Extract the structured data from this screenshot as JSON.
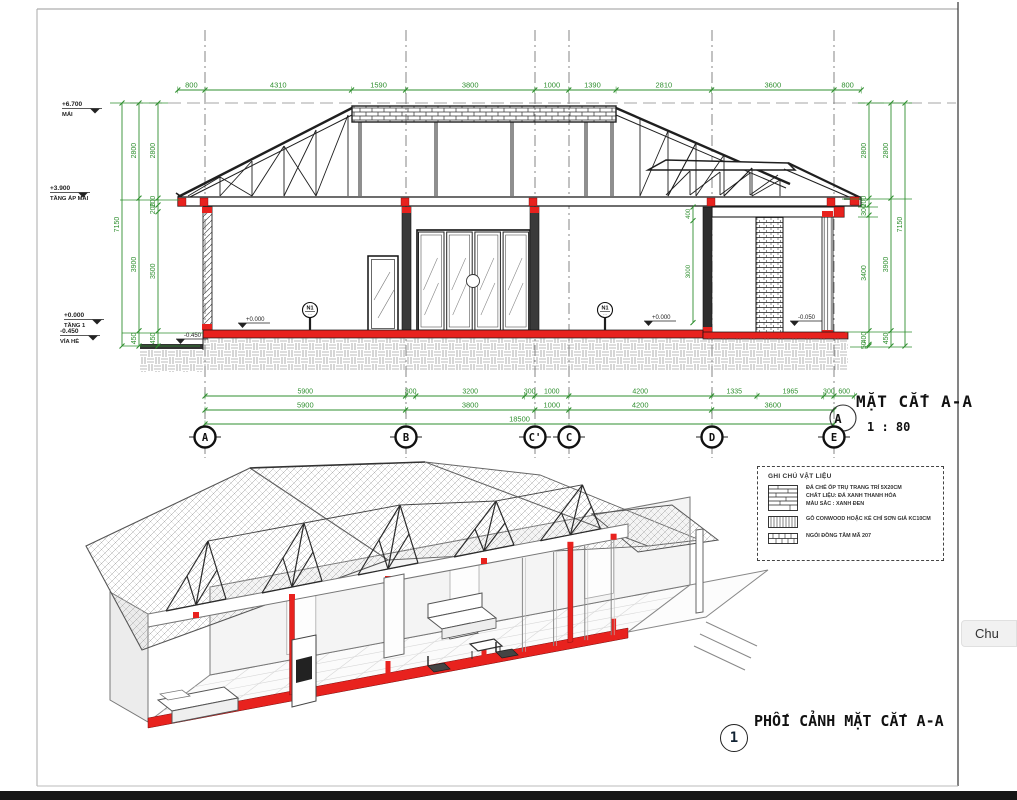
{
  "section": {
    "title": "MẶT CẮT A-A",
    "scale": "1 : 80",
    "view_tag": "A",
    "grid_bubbles": [
      "A",
      "B",
      "C'",
      "C",
      "D",
      "E"
    ],
    "dims_top": [
      "800",
      "4310",
      "1590",
      "3800",
      "1000",
      "1390",
      "2810",
      "3600",
      "800"
    ],
    "dims_bottom_row1": [
      "5900",
      "300",
      "3200",
      "300",
      "1000",
      "4200",
      "1335",
      "1965",
      "300",
      "600"
    ],
    "dims_bottom_row2": [
      "5900",
      "3800",
      "1000",
      "4200",
      "3600"
    ],
    "dims_bottom_total": [
      "18500"
    ],
    "dims_left_cols": [
      [
        "7150"
      ],
      [
        "2800",
        "3900",
        "450"
      ],
      [
        "2800",
        "200",
        "200",
        "3500",
        "450"
      ]
    ],
    "dims_right_cols": [
      [
        "2800",
        "200",
        "300",
        "3400",
        "400",
        "50"
      ],
      [
        "2800",
        "3900",
        "450"
      ],
      [
        "7150"
      ]
    ],
    "dims_wall": [
      "400",
      "3000"
    ],
    "levels_left": [
      {
        "value": "+6.700",
        "label": "MÁI"
      },
      {
        "value": "+3.900",
        "label": "TẦNG ÁP MÁI"
      },
      {
        "value": "+0.000",
        "label": "TẦNG 1"
      },
      {
        "value": "-0.450",
        "label": "VỈA HÈ"
      }
    ],
    "levels_inline": [
      "+0.000",
      "+0.000",
      "-0.450",
      "-0.050"
    ],
    "tags": [
      "N1",
      "N1"
    ]
  },
  "legend": {
    "title": "GHI CHÚ VẬT LIỆU",
    "items": [
      {
        "lines": [
          "ĐÁ CHẺ ỐP TRỤ TRANG TRÍ 5X20CM",
          "CHẤT LIỆU: ĐÁ XANH THANH HÓA",
          "MÀU SẮC : XANH ĐEN"
        ]
      },
      {
        "lines": [
          "GỖ CONWOOD HOẶC KẺ CHỈ SƠN GIẢ KC10CM"
        ]
      },
      {
        "lines": [
          "NGÓI ĐỒNG TÂM MÃ 207"
        ]
      }
    ]
  },
  "perspective": {
    "number": "1",
    "title": "PHỐI CẢNH MẶT CẮT A-A"
  },
  "overlay": {
    "text": "Chu"
  },
  "colors": {
    "dimension_green": "#2f8f2f",
    "cut_red": "#e8221e",
    "line_black": "#1f1f1f"
  }
}
